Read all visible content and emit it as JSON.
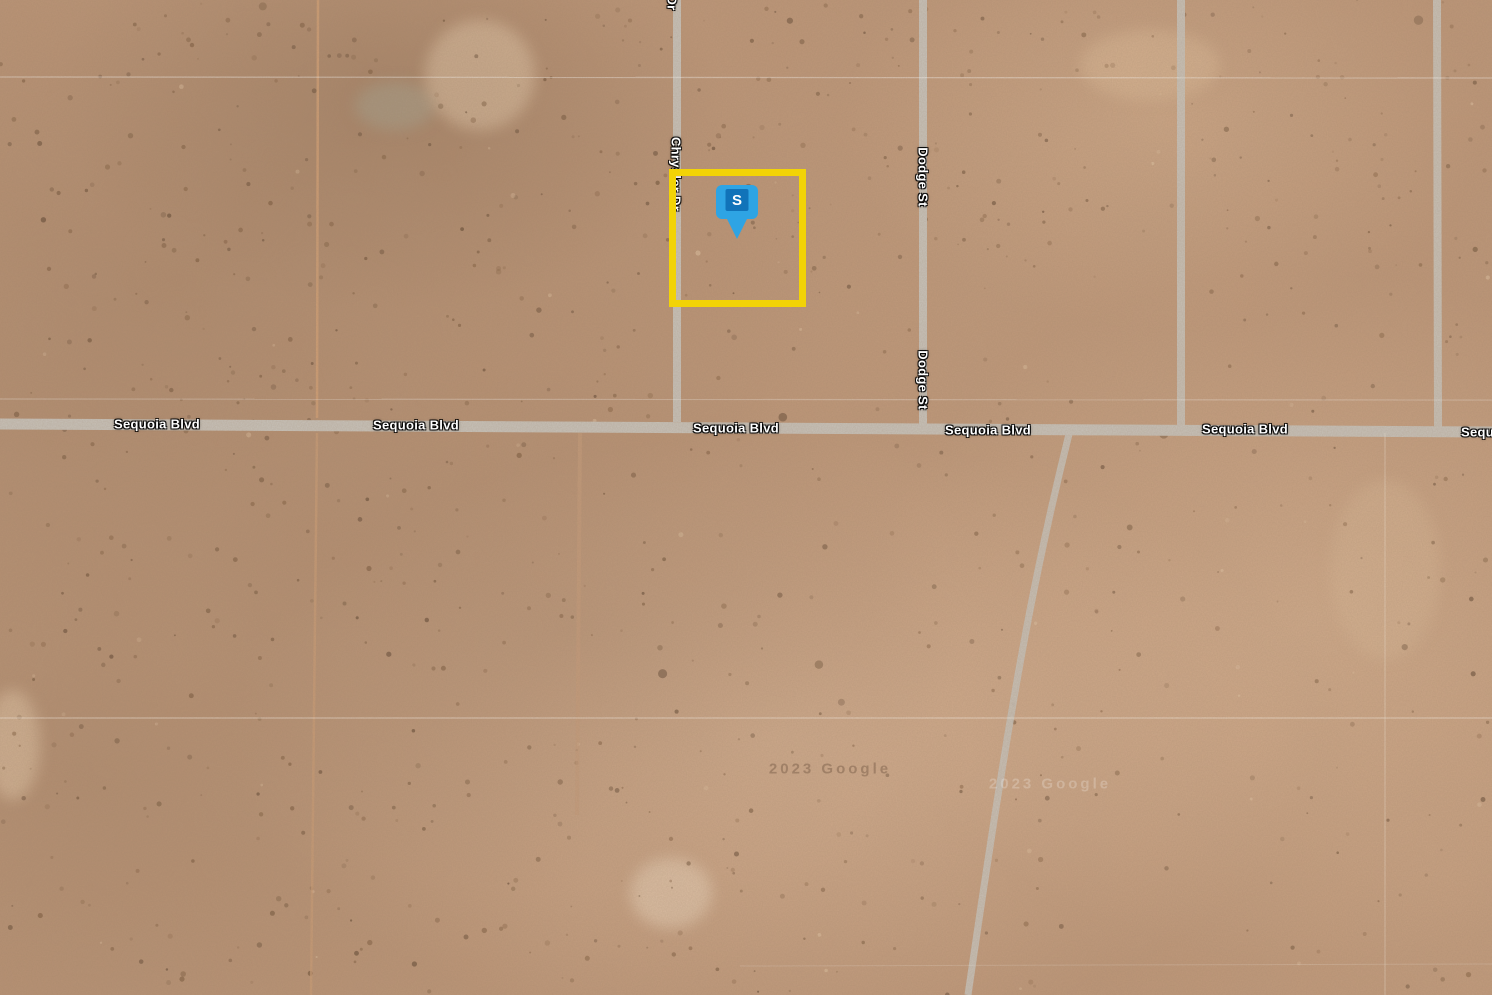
{
  "map": {
    "view_type": "satellite",
    "marker": {
      "label": "S",
      "icon": "square-map-pin-icon"
    },
    "parcel_highlight": {
      "shape": "rectangle",
      "color": "#f2d306"
    },
    "streets": {
      "sequoia": {
        "name": "Sequoia Blvd"
      },
      "chrysler": {
        "name": "Chrysler Dr",
        "short": "Dr"
      },
      "dodge": {
        "name": "Dodge St"
      }
    },
    "watermark": {
      "text": "2023 Google"
    },
    "colors": {
      "terrain": "#bd9678",
      "road": "#c8c3bb",
      "parcel_highlight": "#f2d306",
      "marker_fill": "#2ea4e4",
      "marker_inner": "#1173b9",
      "marker_letter": "#ffffff"
    }
  }
}
